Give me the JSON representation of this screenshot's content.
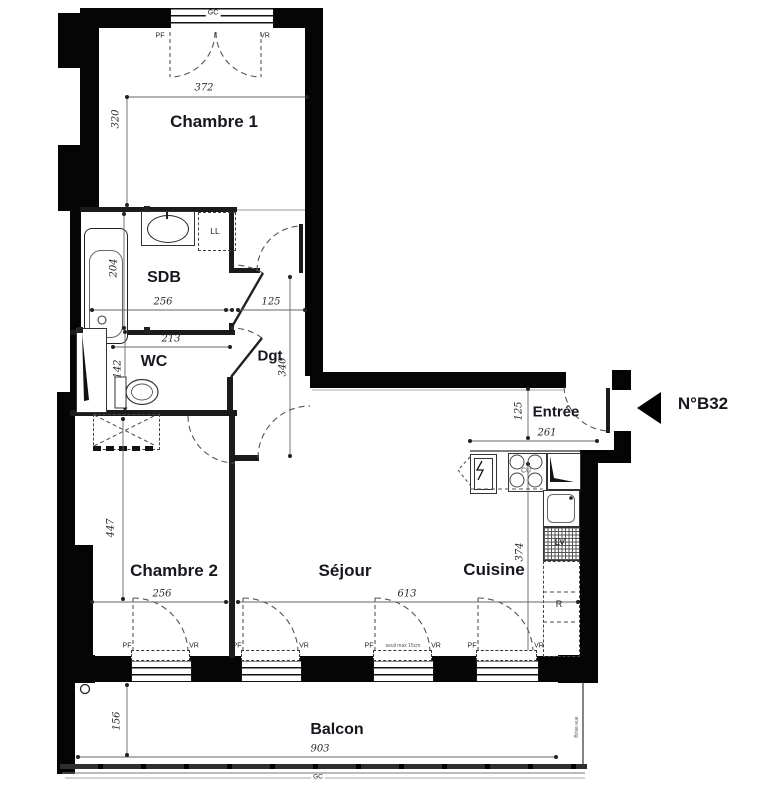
{
  "plan": {
    "unit_label": "N°B32",
    "rooms": {
      "chambre1": "Chambre 1",
      "sdb": "SDB",
      "wc": "WC",
      "dgt": "Dgt",
      "entree": "Entrée",
      "chambre2": "Chambre 2",
      "sejour": "Séjour",
      "cuisine": "Cuisine",
      "balcon": "Balcon"
    },
    "dims": {
      "ch1_w": "372",
      "ch1_h": "320",
      "sdb_w": "256",
      "sdb_door": "125",
      "sdb_h": "204",
      "wc_w": "213",
      "wc_h": "142",
      "dgt_h": "340",
      "entree_h": "125",
      "entree_w": "261",
      "cuisine_h": "374",
      "ch2_h": "447",
      "ch2_w": "256",
      "sejour_w": "613",
      "balcon_h": "156",
      "balcon_w": "903"
    },
    "tags": {
      "gc": "GC",
      "pf": "PF",
      "vr": "VR",
      "ll": "LL",
      "cu": "CU",
      "lv": "LV",
      "r": "R",
      "seuil": "seuil max 15cm",
      "brise_vue": "Brise-vue"
    },
    "colors": {
      "wall": "#050505",
      "line": "#555555",
      "label": "#17181f"
    }
  }
}
